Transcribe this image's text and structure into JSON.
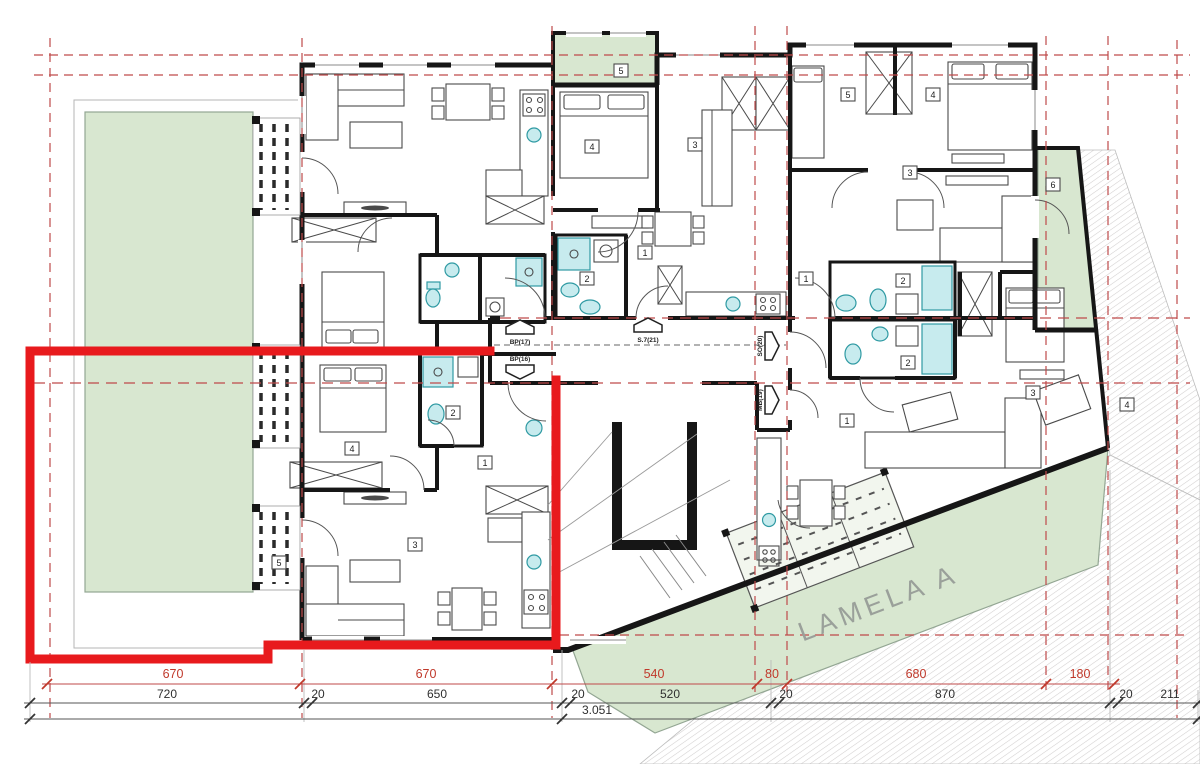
{
  "site": {
    "label": "LAMELA A"
  },
  "corridor": {
    "entrances": [
      {
        "label": "BP(17)"
      },
      {
        "label": "BP(16)"
      },
      {
        "label": "S.7(21)"
      },
      {
        "label": "SO(20)"
      },
      {
        "label": "MB(19)"
      }
    ]
  },
  "rooms": {
    "b_balcony": "5",
    "b_bedroom": "4",
    "b_living": "3",
    "b_bath": "2",
    "b_hall": "1",
    "c_bedroom1": "5",
    "c_bedroom2": "4",
    "c_living": "3",
    "c_bath": "2",
    "c_hall": "1",
    "c_terrace": "6",
    "d_bath": "2",
    "d_bedroom": "3",
    "d_living": "1",
    "d_terrace": "4",
    "e_bedroom": "4",
    "e_bath": "2",
    "e_hall": "1",
    "e_living": "3",
    "e_balcony": "5"
  },
  "dims": {
    "red": [
      "670",
      "670",
      "540",
      "80",
      "680",
      "180"
    ],
    "black": [
      "720",
      "20",
      "650",
      "20",
      "520",
      "20",
      "870",
      "20",
      "211"
    ],
    "total": "3.051"
  },
  "colors": {
    "highlight_red": "#e81a1d",
    "grid_red": "#bf4a4a",
    "terrace_green": "#d8e7d0",
    "fixture_cyan": "#c7ebee",
    "dim_red_text": "#c0392b"
  }
}
